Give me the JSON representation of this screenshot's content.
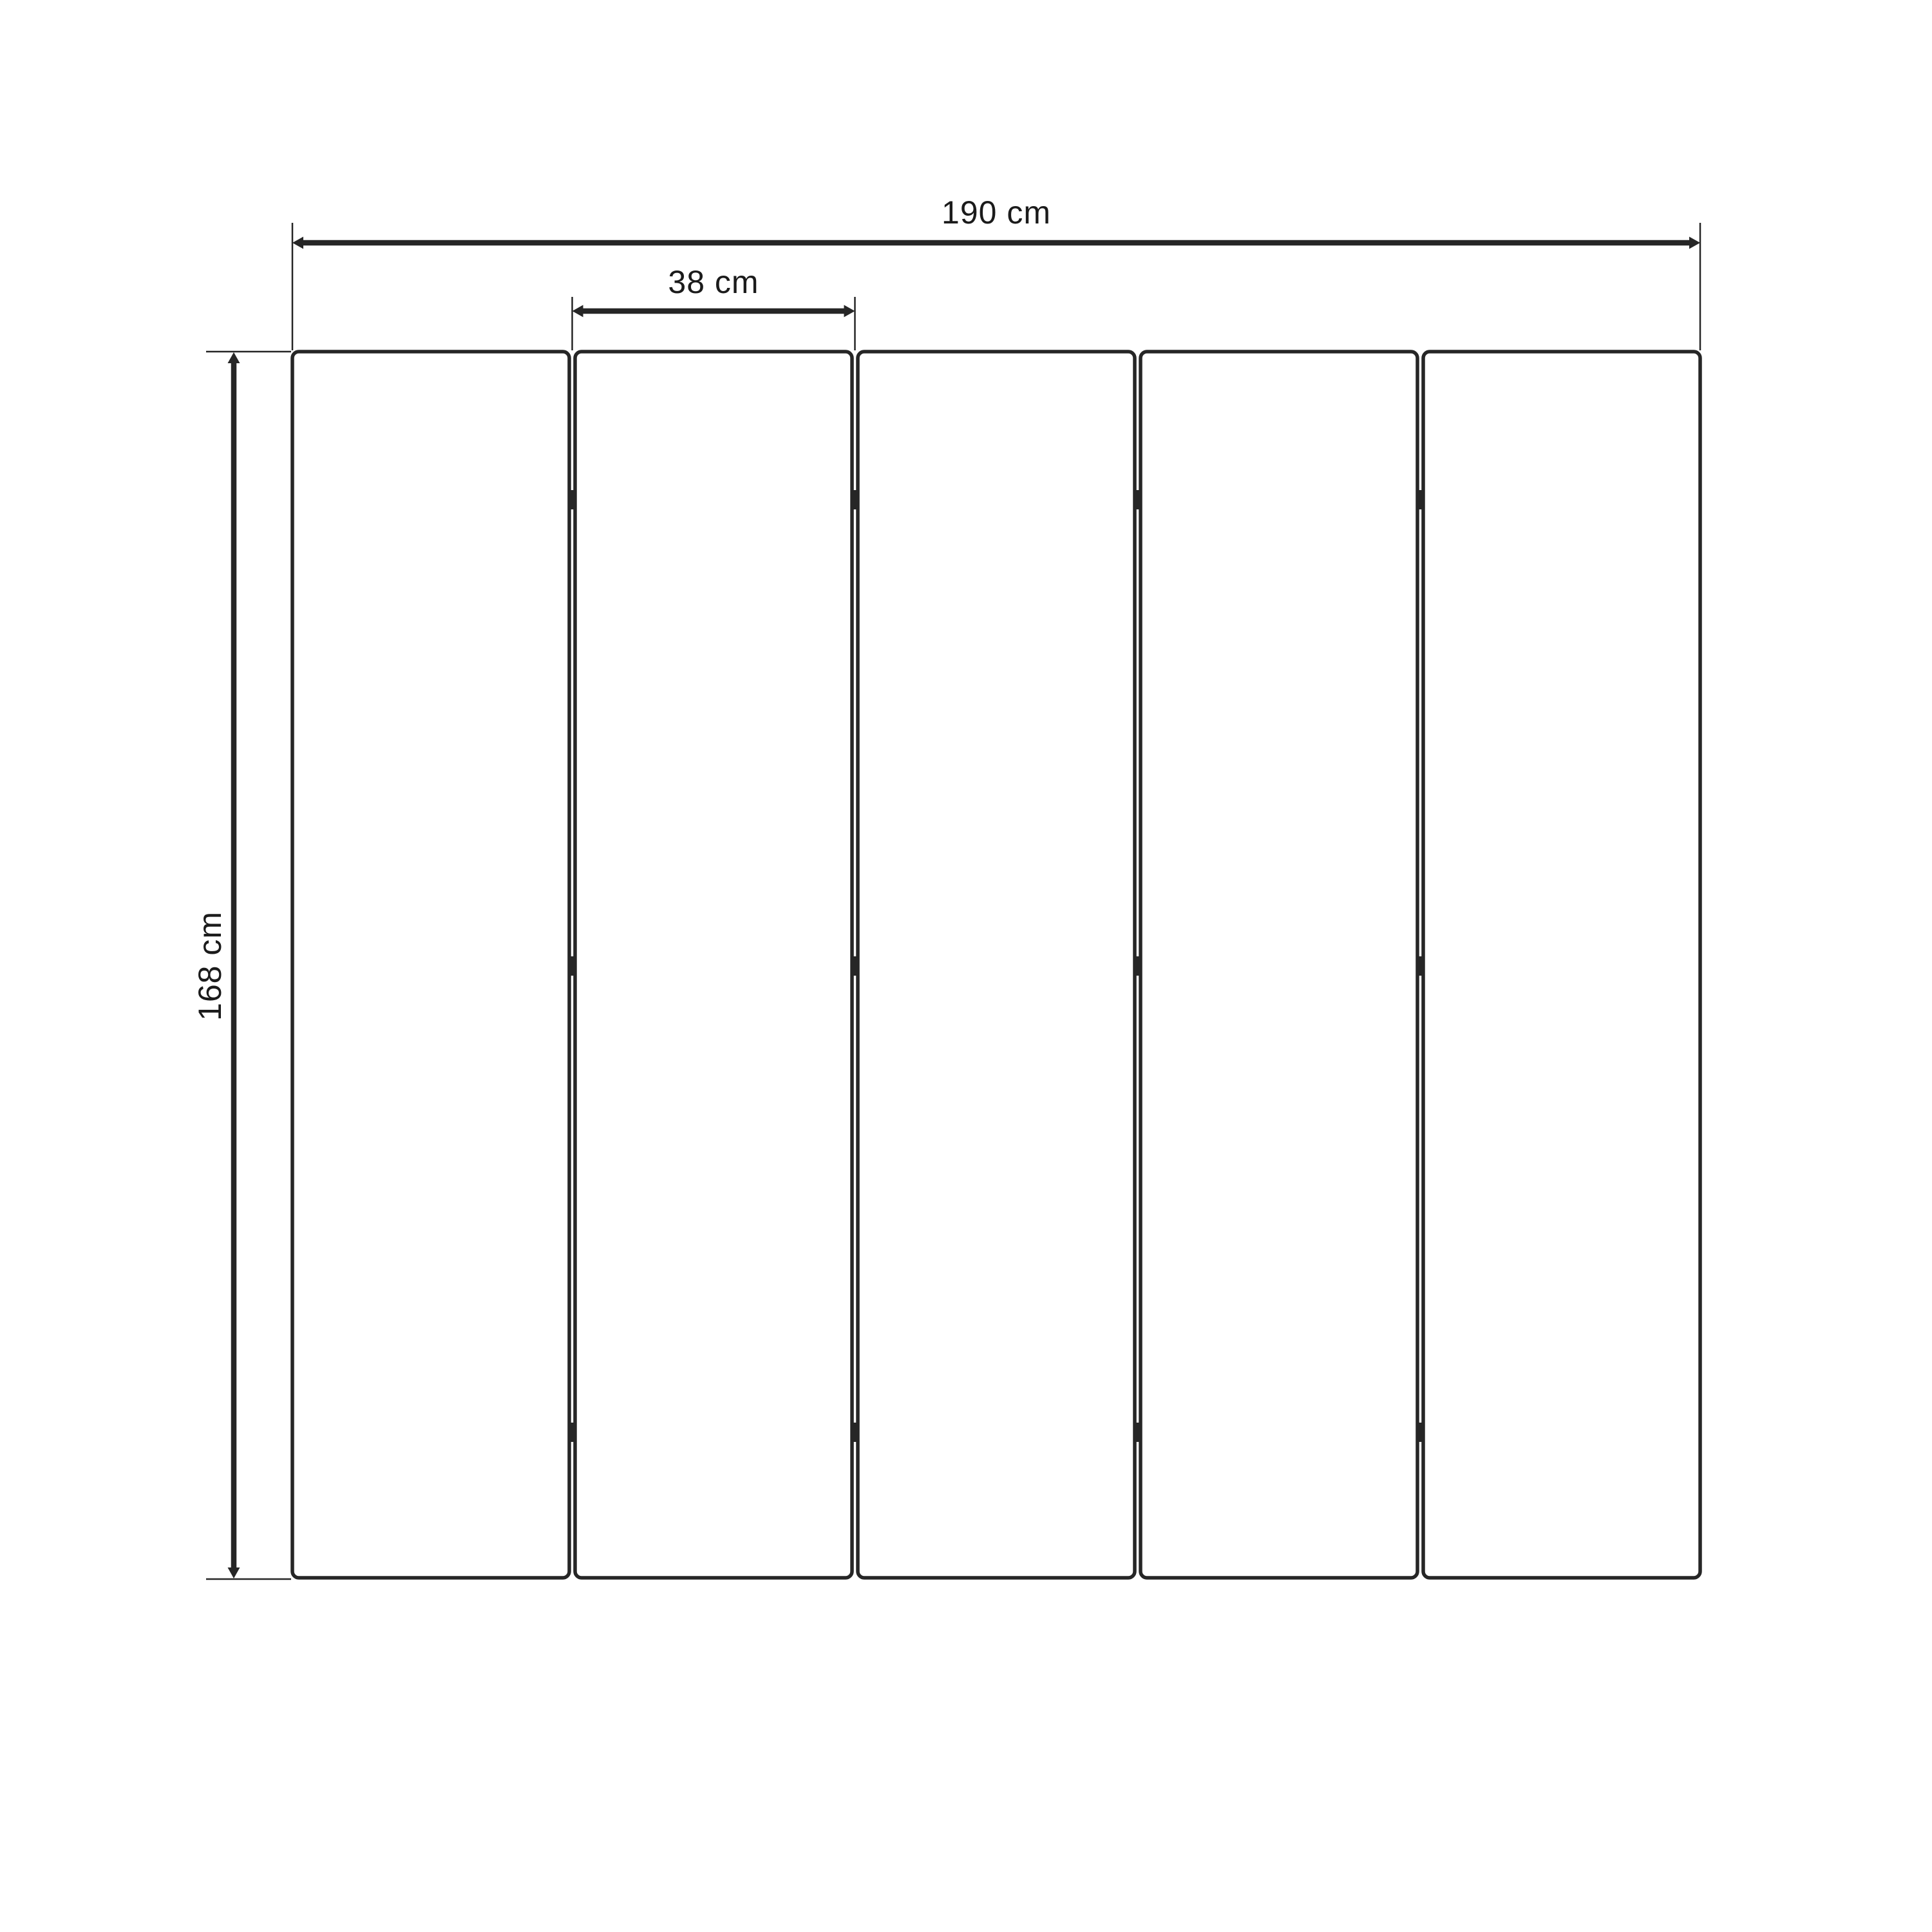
{
  "diagram": {
    "labels": {
      "total_width": "190 cm",
      "panel_width": "38 cm",
      "height": "168 cm"
    },
    "panels": {
      "count": 5
    },
    "hinges": {
      "columns": 4,
      "rows_per_column": 3
    },
    "colors": {
      "line": "#262626",
      "text": "#1b1b1b",
      "background": "#ffffff"
    }
  }
}
